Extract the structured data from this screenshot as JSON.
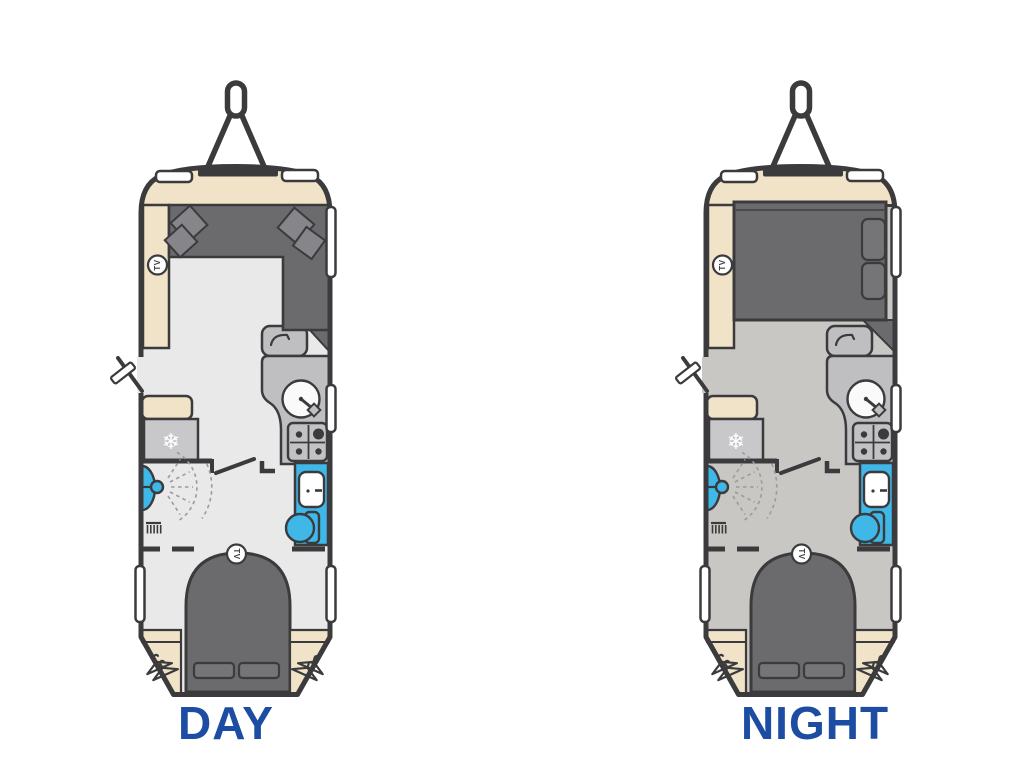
{
  "page": {
    "background": "#ffffff"
  },
  "plans": [
    {
      "id": "day",
      "label": "DAY"
    },
    {
      "id": "night",
      "label": "NIGHT"
    }
  ],
  "icon_labels": {
    "tv": "TV",
    "fridge_snowflake": "❄"
  },
  "colors": {
    "outline_dark": "#3b3b3d",
    "floor_day": "#e9e9ea",
    "floor_night": "#c9c7c4",
    "upholstery_dark_gray": "#6b6b6e",
    "cushion_gray": "#85858a",
    "cabinet_gray": "#bfbfc1",
    "fridge_gray": "#c8c8ca",
    "worktop_beige": "#f0e3c7",
    "fixture_blue": "#3fb8e8",
    "basin_white": "#ffffff",
    "label_blue": "#1d4da2"
  }
}
